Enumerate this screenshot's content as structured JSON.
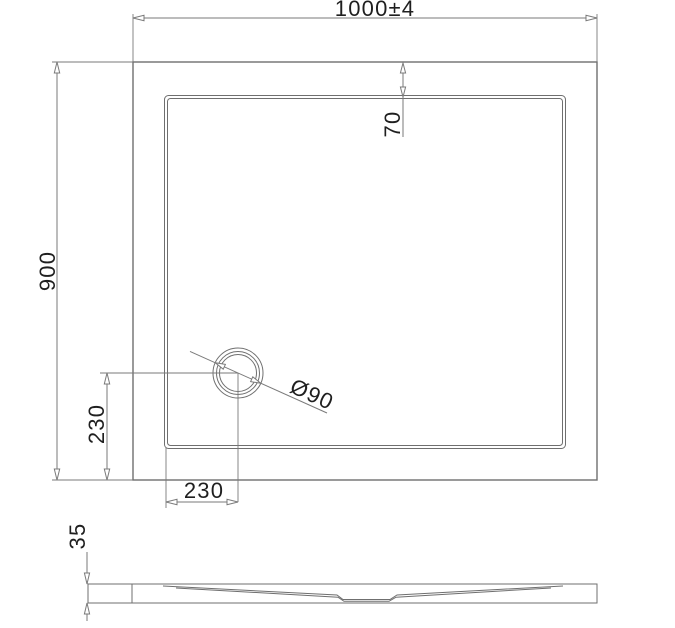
{
  "drawing": {
    "title": "shower-tray-technical-drawing",
    "background_color": "#ffffff",
    "line_color": "#6f6f6f",
    "dim_line_color": "#7a7a7a",
    "text_color": "#1f1f1f",
    "dimensions": {
      "overall_width": "1000±4",
      "overall_depth": "900",
      "drain_inset_from_top_edge": "70",
      "drain_offset_vertical": "230",
      "drain_offset_horizontal": "230",
      "drain_diameter": "Ø90",
      "tray_height": "35"
    }
  }
}
